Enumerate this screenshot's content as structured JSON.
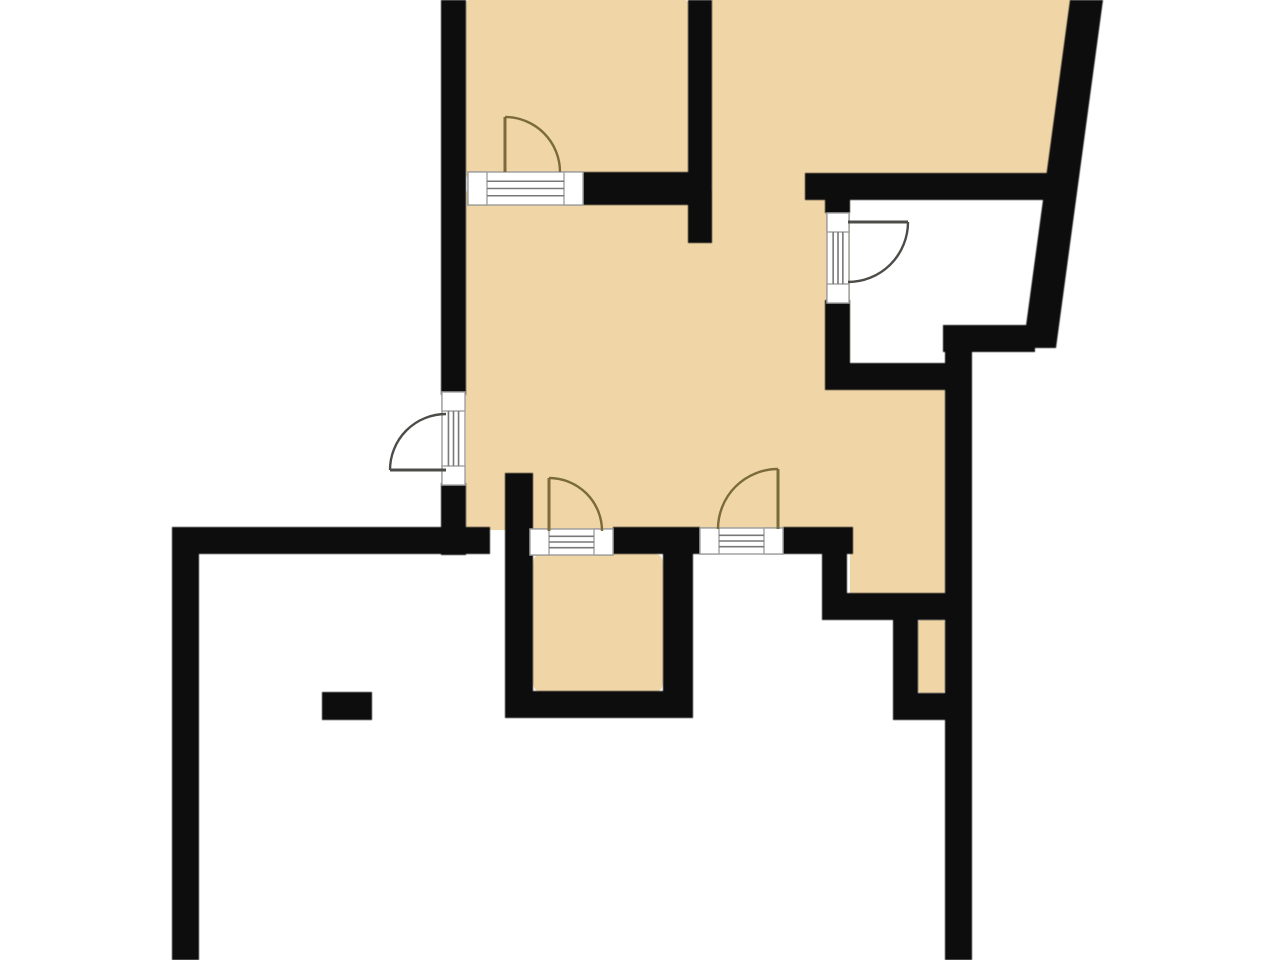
{
  "app": {
    "kind": "architectural-floor-plan",
    "background": "#ffffff"
  },
  "canvas": {
    "width": 1280,
    "height": 960
  },
  "colors": {
    "wall": "#101010",
    "floor": "#f0d5a6",
    "arc_tan": "#7a6a3c",
    "arc_gray": "#4e4c48",
    "sill_fill": "#ffffff",
    "sill_border": "#9b9b9b",
    "sill_line": "#787878"
  },
  "floors": [
    {
      "name": "room-floor-top-left",
      "x": 466,
      "y": 0,
      "w": 222,
      "h": 178
    },
    {
      "name": "room-floor-top-right",
      "points": "712,0 1072,0 1047,192 712,192"
    },
    {
      "name": "room-floor-main",
      "x": 466,
      "y": 190,
      "w": 384,
      "h": 340
    },
    {
      "name": "room-floor-right-arm",
      "x": 850,
      "y": 385,
      "w": 95,
      "h": 225
    },
    {
      "name": "room-floor-hallway",
      "x": 533,
      "y": 553,
      "w": 130,
      "h": 140,
      "rx": 10
    },
    {
      "name": "room-floor-nook",
      "x": 918,
      "y": 620,
      "w": 27,
      "h": 73
    }
  ],
  "walls": [
    {
      "name": "wall-left-upper",
      "x": 441,
      "y": 0,
      "w": 25,
      "h": 395
    },
    {
      "name": "wall-left-lower",
      "x": 441,
      "y": 483,
      "w": 25,
      "h": 72
    },
    {
      "name": "wall-top-divider",
      "x": 583,
      "y": 172,
      "w": 129,
      "h": 33
    },
    {
      "name": "wall-top-middle-vertical",
      "x": 688,
      "y": 0,
      "w": 24,
      "h": 243
    },
    {
      "name": "wall-lower-room-top-left",
      "x": 172,
      "y": 527,
      "w": 318,
      "h": 27
    },
    {
      "name": "wall-lower-room-top-mid",
      "x": 613,
      "y": 527,
      "w": 87,
      "h": 27
    },
    {
      "name": "wall-lower-room-top-right",
      "x": 783,
      "y": 527,
      "w": 70,
      "h": 27
    },
    {
      "name": "wall-hallway-left",
      "x": 505,
      "y": 473,
      "w": 28,
      "h": 245
    },
    {
      "name": "wall-hallway-bottom",
      "x": 505,
      "y": 691,
      "w": 188,
      "h": 27
    },
    {
      "name": "wall-hallway-right",
      "x": 663,
      "y": 527,
      "w": 30,
      "h": 191
    },
    {
      "name": "wall-outer-left",
      "x": 172,
      "y": 527,
      "w": 27,
      "h": 433
    },
    {
      "name": "wall-outer-right",
      "x": 945,
      "y": 325,
      "w": 27,
      "h": 635
    },
    {
      "name": "wall-right-arm-bottom",
      "x": 847,
      "y": 593,
      "w": 100,
      "h": 27
    },
    {
      "name": "wall-right-arm-step",
      "x": 822,
      "y": 553,
      "w": 25,
      "h": 67
    },
    {
      "name": "wall-nook-left",
      "x": 893,
      "y": 620,
      "w": 25,
      "h": 76
    },
    {
      "name": "wall-nook-bottom",
      "x": 893,
      "y": 693,
      "w": 54,
      "h": 27
    },
    {
      "name": "wall-closet-left-lower",
      "x": 825,
      "y": 300,
      "w": 25,
      "h": 67
    },
    {
      "name": "wall-closet-left-upper",
      "x": 825,
      "y": 186,
      "w": 25,
      "h": 27
    },
    {
      "name": "wall-closet-top",
      "x": 805,
      "y": 173,
      "w": 257,
      "h": 27
    },
    {
      "name": "wall-closet-bottom-left",
      "x": 825,
      "y": 363,
      "w": 128,
      "h": 27
    },
    {
      "name": "wall-closet-bottom-right",
      "x": 943,
      "y": 325,
      "w": 92,
      "h": 27
    },
    {
      "name": "wall-diagonal-outer",
      "points": "1070,0 1103,0 1056,348 1023,348"
    },
    {
      "name": "pillar",
      "x": 322,
      "y": 692,
      "w": 50,
      "h": 28
    }
  ],
  "sills": [
    {
      "name": "door-sill-entry-left",
      "x": 442,
      "y": 392,
      "w": 23,
      "h": 93,
      "dir": "v"
    },
    {
      "name": "door-sill-top-left-room",
      "x": 468,
      "y": 172,
      "w": 115,
      "h": 33,
      "dir": "h"
    },
    {
      "name": "door-sill-hallway",
      "x": 530,
      "y": 529,
      "w": 83,
      "h": 26,
      "dir": "h"
    },
    {
      "name": "door-sill-main-room",
      "x": 700,
      "y": 528,
      "w": 83,
      "h": 26,
      "dir": "h"
    },
    {
      "name": "door-sill-closet",
      "x": 827,
      "y": 213,
      "w": 22,
      "h": 90,
      "dir": "v"
    }
  ],
  "doors": [
    {
      "name": "door-swing-entry-left",
      "arc": "M 390,470 A 56,56 0 0 1 446,414",
      "leaf": [
        390,
        470,
        446,
        470
      ],
      "color": "arc_gray"
    },
    {
      "name": "door-swing-top-left-room",
      "arc": "M 505,117 A 55,55 0 0 1 560,172",
      "leaf": [
        505,
        117,
        505,
        172
      ],
      "color": "arc_tan"
    },
    {
      "name": "door-swing-hallway",
      "arc": "M 549,478 A 53,53 0 0 1 602,531",
      "leaf": [
        549,
        478,
        549,
        531
      ],
      "color": "arc_tan"
    },
    {
      "name": "door-swing-main-room",
      "arc": "M 778,469 A 60,60 0 0 0 718,529",
      "leaf": [
        778,
        469,
        778,
        529
      ],
      "color": "arc_tan"
    },
    {
      "name": "door-swing-closet",
      "arc": "M 908,222 A 60,60 0 0 1 848,282",
      "leaf": [
        848,
        222,
        908,
        222
      ],
      "color": "arc_gray"
    }
  ]
}
